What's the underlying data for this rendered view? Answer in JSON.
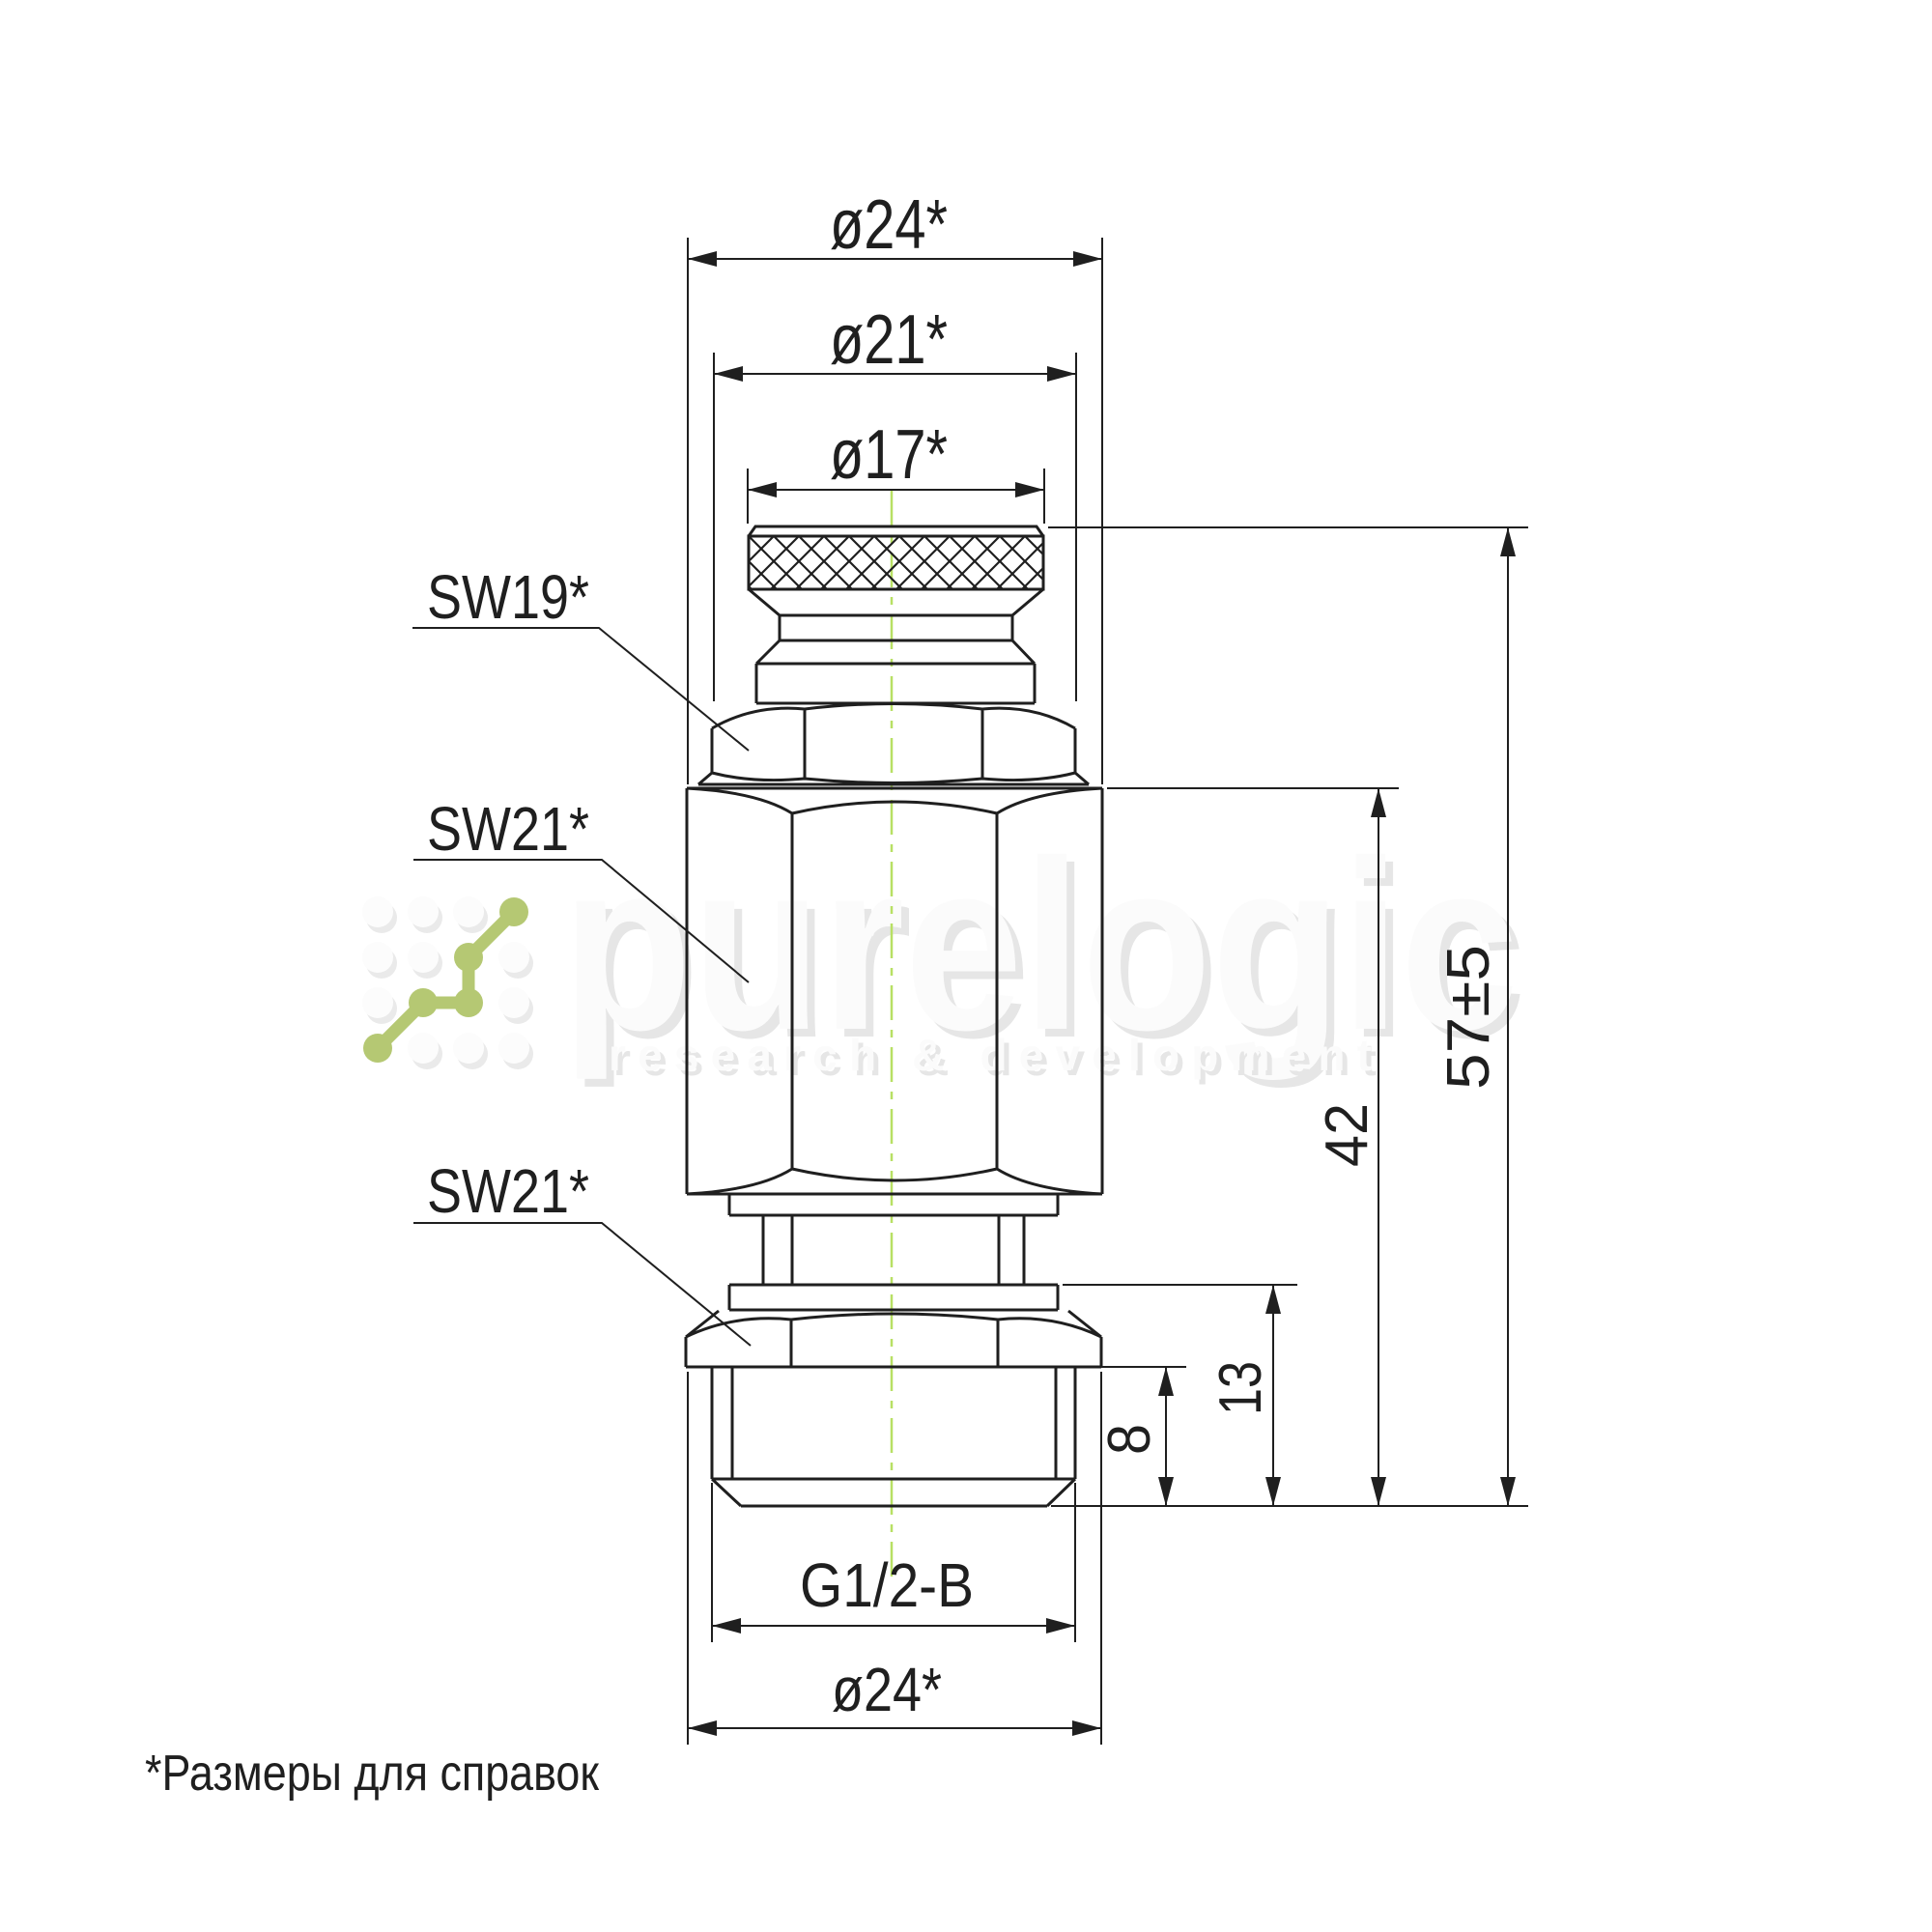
{
  "page": {
    "background": "#ffffff"
  },
  "watermark": {
    "brand": "purelogic",
    "tagline": "research & development",
    "logo_green": "#b5c873",
    "text_color": "#fbfbfb",
    "shadow_color": "#e6e6e6"
  },
  "drawing": {
    "line_color": "#1f1f1f",
    "centerline_color": "#b8e064",
    "labels": {
      "sw19": "SW19*",
      "sw21_upper": "SW21*",
      "sw21_lower": "SW21*"
    },
    "dimensions": {
      "dia24_top": "ø24*",
      "dia21": "ø21*",
      "dia17": "ø17*",
      "height_total": "57±5",
      "height_to_hex_top": "42",
      "height_13": "13",
      "height_8": "8",
      "thread": "G1/2-B",
      "dia24_bottom": "ø24*"
    },
    "footnote": "*Размеры для справок"
  }
}
